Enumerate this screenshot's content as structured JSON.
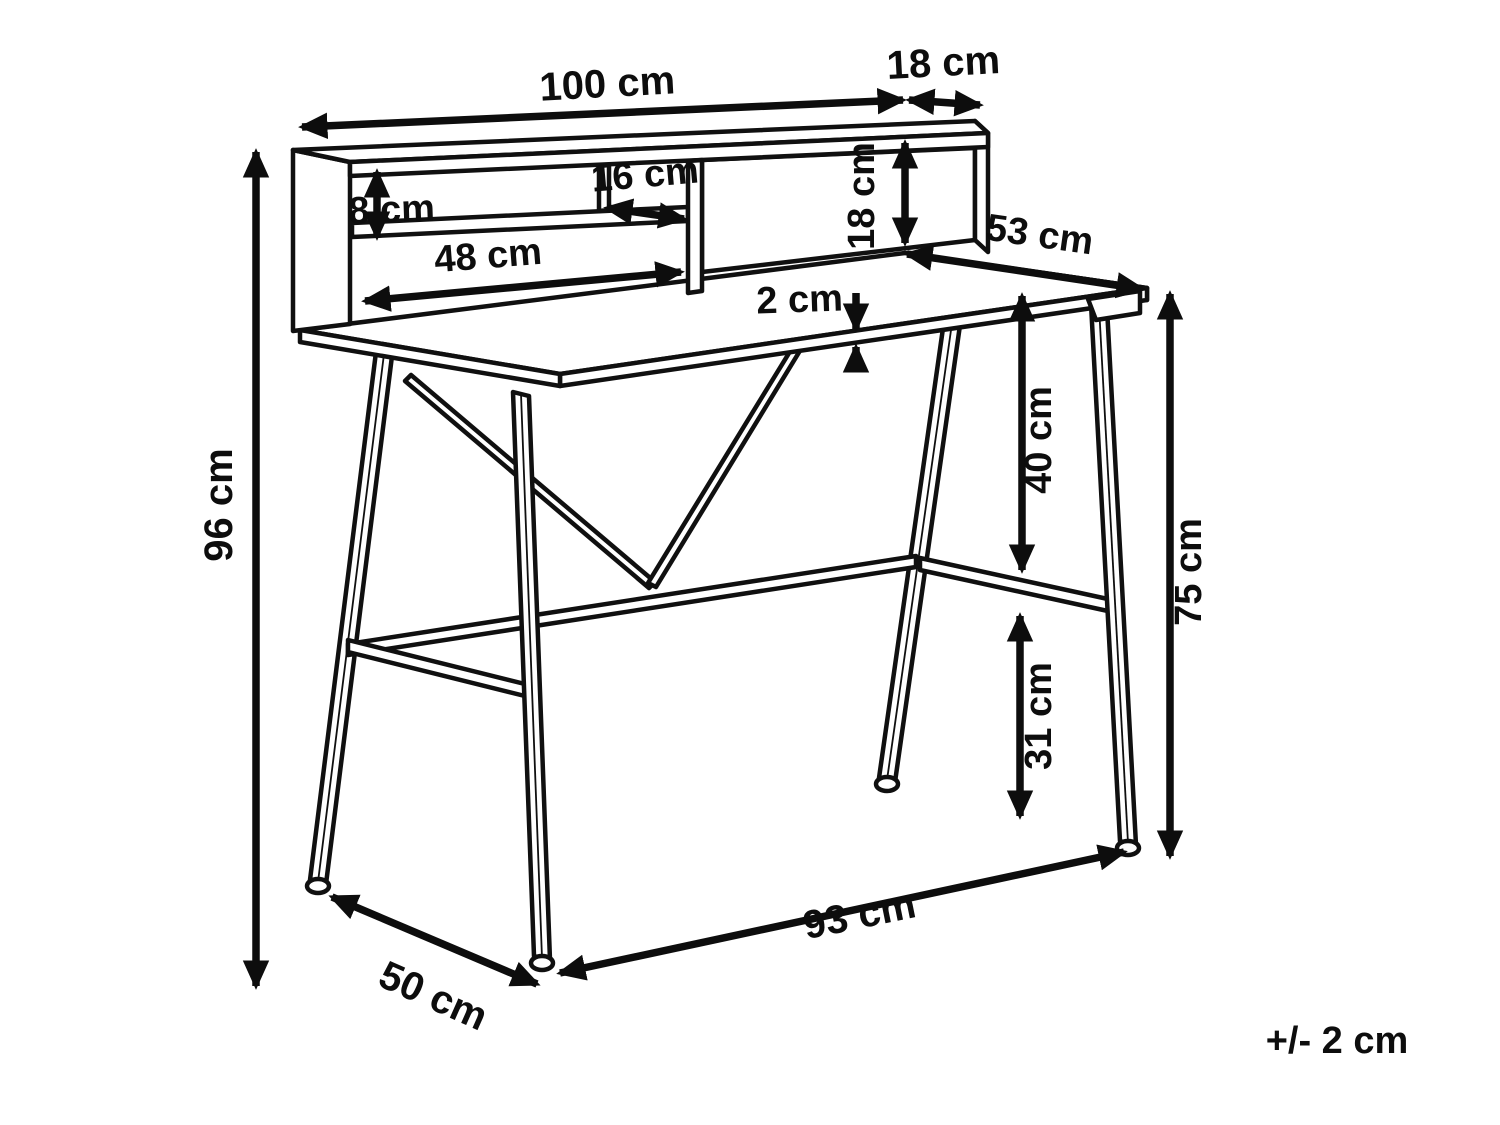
{
  "dims": {
    "hutch_width": "100 cm",
    "hutch_depth": "18 cm",
    "shelf_gap": "8 cm",
    "cubby_width": "16 cm",
    "hutch_opening_height": "18 cm",
    "shelf_width": "48 cm",
    "desktop_depth": "53 cm",
    "desktop_thickness": "2 cm",
    "desktop_to_stretcher": "40 cm",
    "total_height": "96 cm",
    "desktop_height": "75 cm",
    "stretcher_to_floor": "31 cm",
    "base_depth": "50 cm",
    "base_width": "93 cm",
    "tolerance": "+/- 2 cm"
  }
}
